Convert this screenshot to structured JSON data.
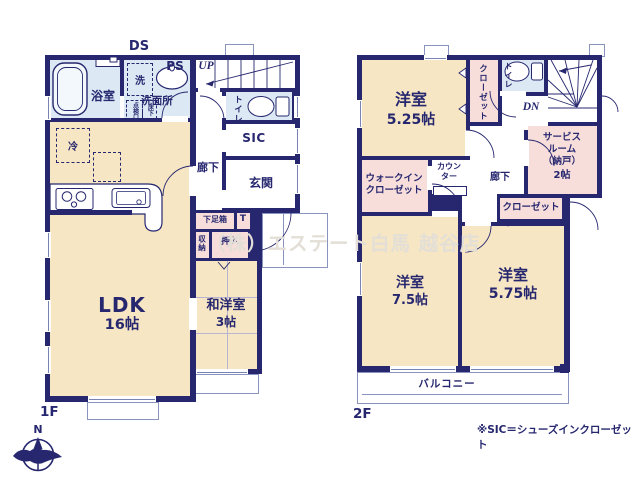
{
  "colors": {
    "wall": "#26276f",
    "ink": "#26276f",
    "tatami_cream": "#f6e6c3",
    "water_blue": "#dce9f4",
    "closet_pink": "#f8dedb",
    "outline_gray": "#8a93bd",
    "watermark": "#e3dfd7"
  },
  "floor1": {
    "label": "1F",
    "ds": "DS",
    "ps": "PS",
    "up": "UP",
    "bath": "浴室",
    "washer": "洗",
    "washroom": "洗面所",
    "inspection": "点検口",
    "underfloor": "床下",
    "toilet": "トイレ",
    "sic": "SIC",
    "entrance": "玄関",
    "hall": "廊下",
    "shoebox": "下足箱",
    "t_label": "T",
    "storage": "収納",
    "oshiire": "押入",
    "fridge": "冷",
    "ldk": {
      "name": "LDK",
      "size": "16帖"
    },
    "washitsu": {
      "name": "和洋室",
      "size": "3帖"
    }
  },
  "floor2": {
    "label": "2F",
    "dn": "DN",
    "room525": {
      "name": "洋室",
      "size": "5.25帖"
    },
    "closet_upper": "クローゼット",
    "toilet": "トイレ",
    "service": {
      "l1": "サービス",
      "l2": "ルーム",
      "l3": "（納戸）",
      "l4": "2帖"
    },
    "hall": "廊下",
    "wic": {
      "l1": "ウォークイン",
      "l2": "クローゼット"
    },
    "counter": {
      "l1": "カウン",
      "l2": "ター"
    },
    "closet_lower": "クローゼット",
    "room75": {
      "name": "洋室",
      "size": "7.5帖"
    },
    "room575": {
      "name": "洋室",
      "size": "5.75帖"
    },
    "balcony": "バルコニー"
  },
  "annotations": {
    "watermark": "（株）エステート白馬 越谷店",
    "footnote": "※SIC＝シューズインクローゼット",
    "compass_north": "N"
  }
}
